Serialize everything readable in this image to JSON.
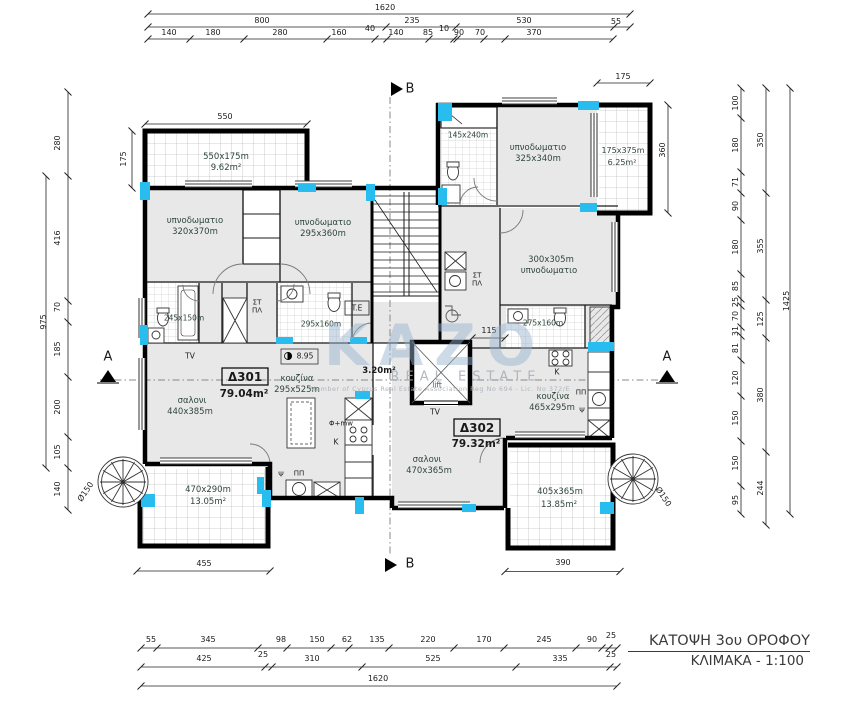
{
  "title_block": {
    "line1": "ΚΑΤΟΨΗ 3ου ΟΡΟΦΟΥ",
    "line2": "ΚΛΙΜΑΚΑ - 1:100"
  },
  "watermark": {
    "name": "KAZO",
    "subtitle": "REAL ESTATE",
    "note": "Member of Cyprus Real Estate Association   Reg No 694 - Lic. No 372/E"
  },
  "apartments": [
    {
      "id": "Δ301",
      "area": "79.04m²"
    },
    {
      "id": "Δ302",
      "area": "79.32m²"
    }
  ],
  "lift_area": "3.20m²",
  "level_mark": "8.95",
  "colors": {
    "marker": "#29BCEE",
    "room_fill": "#e8e8e8",
    "room_label": "#2e463b",
    "dim": "#1a1a1a"
  },
  "plan": {
    "labels": [
      {
        "t": "1620",
        "x": 385,
        "y": 8,
        "n": "dim-top"
      },
      {
        "t": "800",
        "x": 262,
        "y": 21,
        "n": "dim-top"
      },
      {
        "t": "235",
        "x": 412,
        "y": 21,
        "n": "dim-top"
      },
      {
        "t": "530",
        "x": 524,
        "y": 21,
        "n": "dim-top"
      },
      {
        "t": "55",
        "x": 616,
        "y": 22,
        "n": "dim-top"
      },
      {
        "t": "140",
        "x": 169,
        "y": 33,
        "n": "dim-top"
      },
      {
        "t": "180",
        "x": 213,
        "y": 33,
        "n": "dim-top"
      },
      {
        "t": "280",
        "x": 280,
        "y": 33,
        "n": "dim-top"
      },
      {
        "t": "160",
        "x": 339,
        "y": 33,
        "n": "dim-top"
      },
      {
        "t": "40",
        "x": 370,
        "y": 29,
        "n": "dim-top"
      },
      {
        "t": "140",
        "x": 396,
        "y": 33,
        "n": "dim-top"
      },
      {
        "t": "85",
        "x": 428,
        "y": 33,
        "n": "dim-top"
      },
      {
        "t": "10",
        "x": 444,
        "y": 29,
        "n": "dim-top"
      },
      {
        "t": "90",
        "x": 459,
        "y": 33,
        "n": "dim-top"
      },
      {
        "t": "70",
        "x": 480,
        "y": 33,
        "n": "dim-top"
      },
      {
        "t": "370",
        "x": 534,
        "y": 33,
        "n": "dim-top"
      },
      {
        "t": "550",
        "x": 225,
        "y": 117,
        "n": "dim-balcony"
      },
      {
        "t": "175",
        "x": 124,
        "y": 159,
        "r": -90,
        "n": "dim-balcony"
      },
      {
        "t": "175",
        "x": 623,
        "y": 77,
        "n": "dim-balcony"
      },
      {
        "t": "360",
        "x": 663,
        "y": 150,
        "r": -90,
        "n": "dim-balcony"
      },
      {
        "t": "115",
        "x": 489,
        "y": 331,
        "n": "dim-inner"
      },
      {
        "t": "455",
        "x": 204,
        "y": 564,
        "n": "dim-balcony"
      },
      {
        "t": "390",
        "x": 563,
        "y": 563,
        "n": "dim-balcony"
      },
      {
        "t": "55",
        "x": 151,
        "y": 640,
        "n": "dim-bottom"
      },
      {
        "t": "345",
        "x": 208,
        "y": 640,
        "n": "dim-bottom"
      },
      {
        "t": "98",
        "x": 281,
        "y": 640,
        "n": "dim-bottom"
      },
      {
        "t": "150",
        "x": 317,
        "y": 640,
        "n": "dim-bottom"
      },
      {
        "t": "62",
        "x": 347,
        "y": 640,
        "n": "dim-bottom"
      },
      {
        "t": "135",
        "x": 377,
        "y": 640,
        "n": "dim-bottom"
      },
      {
        "t": "220",
        "x": 428,
        "y": 640,
        "n": "dim-bottom"
      },
      {
        "t": "170",
        "x": 484,
        "y": 640,
        "n": "dim-bottom"
      },
      {
        "t": "245",
        "x": 544,
        "y": 640,
        "n": "dim-bottom"
      },
      {
        "t": "90",
        "x": 592,
        "y": 640,
        "n": "dim-bottom"
      },
      {
        "t": "25",
        "x": 611,
        "y": 636,
        "n": "dim-bottom"
      },
      {
        "t": "425",
        "x": 204,
        "y": 659,
        "n": "dim-bottom"
      },
      {
        "t": "25",
        "x": 263,
        "y": 655,
        "n": "dim-bottom"
      },
      {
        "t": "310",
        "x": 312,
        "y": 659,
        "n": "dim-bottom"
      },
      {
        "t": "525",
        "x": 433,
        "y": 659,
        "n": "dim-bottom"
      },
      {
        "t": "335",
        "x": 560,
        "y": 659,
        "n": "dim-bottom"
      },
      {
        "t": "25",
        "x": 611,
        "y": 655,
        "n": "dim-bottom"
      },
      {
        "t": "1620",
        "x": 378,
        "y": 679,
        "n": "dim-bottom"
      },
      {
        "t": "280",
        "x": 58,
        "y": 143,
        "r": -90,
        "n": "dim-left"
      },
      {
        "t": "416",
        "x": 58,
        "y": 238,
        "r": -90,
        "n": "dim-left"
      },
      {
        "t": "70",
        "x": 58,
        "y": 307,
        "r": -90,
        "n": "dim-left"
      },
      {
        "t": "185",
        "x": 58,
        "y": 349,
        "r": -90,
        "n": "dim-left"
      },
      {
        "t": "200",
        "x": 58,
        "y": 407,
        "r": -90,
        "n": "dim-left"
      },
      {
        "t": "105",
        "x": 58,
        "y": 452,
        "r": -90,
        "n": "dim-left"
      },
      {
        "t": "140",
        "x": 58,
        "y": 489,
        "r": -90,
        "n": "dim-left"
      },
      {
        "t": "975",
        "x": 44,
        "y": 322,
        "r": -90,
        "n": "dim-left"
      },
      {
        "t": "Ø150",
        "x": 86,
        "y": 492,
        "r": -56,
        "n": "dim-stair"
      },
      {
        "t": "Ø150",
        "x": 663,
        "y": 497,
        "r": 56,
        "n": "dim-stair"
      },
      {
        "t": "100",
        "x": 736,
        "y": 103,
        "r": -90,
        "n": "dim-right"
      },
      {
        "t": "180",
        "x": 736,
        "y": 145,
        "r": -90,
        "n": "dim-right"
      },
      {
        "t": "71",
        "x": 736,
        "y": 182,
        "r": -90,
        "n": "dim-right"
      },
      {
        "t": "90",
        "x": 736,
        "y": 206,
        "r": -90,
        "n": "dim-right"
      },
      {
        "t": "180",
        "x": 736,
        "y": 247,
        "r": -90,
        "n": "dim-right"
      },
      {
        "t": "85",
        "x": 736,
        "y": 286,
        "r": -90,
        "n": "dim-right"
      },
      {
        "t": "25",
        "x": 736,
        "y": 302,
        "r": -90,
        "n": "dim-right"
      },
      {
        "t": "70",
        "x": 736,
        "y": 316,
        "r": -90,
        "n": "dim-right"
      },
      {
        "t": "31",
        "x": 736,
        "y": 331,
        "r": -90,
        "n": "dim-right"
      },
      {
        "t": "81",
        "x": 736,
        "y": 348,
        "r": -90,
        "n": "dim-right"
      },
      {
        "t": "120",
        "x": 736,
        "y": 378,
        "r": -90,
        "n": "dim-right"
      },
      {
        "t": "150",
        "x": 736,
        "y": 418,
        "r": -90,
        "n": "dim-right"
      },
      {
        "t": "150",
        "x": 736,
        "y": 463,
        "r": -90,
        "n": "dim-right"
      },
      {
        "t": "95",
        "x": 736,
        "y": 500,
        "r": -90,
        "n": "dim-right"
      },
      {
        "t": "350",
        "x": 761,
        "y": 140,
        "r": -90,
        "n": "dim-right"
      },
      {
        "t": "355",
        "x": 761,
        "y": 246,
        "r": -90,
        "n": "dim-right"
      },
      {
        "t": "125",
        "x": 761,
        "y": 319,
        "r": -90,
        "n": "dim-right"
      },
      {
        "t": "380",
        "x": 761,
        "y": 395,
        "r": -90,
        "n": "dim-right"
      },
      {
        "t": "244",
        "x": 761,
        "y": 488,
        "r": -90,
        "n": "dim-right"
      },
      {
        "t": "1425",
        "x": 787,
        "y": 301,
        "r": -90,
        "n": "dim-right"
      },
      {
        "t": "550x175m",
        "x": 226,
        "y": 157,
        "s": 8.5,
        "c": "g",
        "n": "room-size"
      },
      {
        "t": "9.62m²",
        "x": 226,
        "y": 168,
        "s": 8.5,
        "c": "g",
        "n": "room-area"
      },
      {
        "t": "υπνοδωματιο",
        "x": 195,
        "y": 221,
        "s": 8.5,
        "c": "g",
        "n": "room-name"
      },
      {
        "t": "320x370m",
        "x": 195,
        "y": 232,
        "s": 8.5,
        "c": "g",
        "n": "room-size"
      },
      {
        "t": "υπνοδωματιο",
        "x": 323,
        "y": 223,
        "s": 8.5,
        "c": "g",
        "n": "room-name"
      },
      {
        "t": "295x360m",
        "x": 323,
        "y": 234,
        "s": 8.5,
        "c": "g",
        "n": "room-size"
      },
      {
        "t": "145x240m",
        "x": 468,
        "y": 135,
        "s": 7.5,
        "c": "g",
        "n": "room-size"
      },
      {
        "t": "υπνοδωματιο",
        "x": 538,
        "y": 148,
        "s": 8.5,
        "c": "g",
        "n": "room-name"
      },
      {
        "t": "325x340m",
        "x": 538,
        "y": 159,
        "s": 8.5,
        "c": "g",
        "n": "room-size"
      },
      {
        "t": "175x375m",
        "x": 623,
        "y": 151,
        "s": 8,
        "c": "g",
        "n": "room-size"
      },
      {
        "t": "6.25m²",
        "x": 622,
        "y": 163,
        "s": 8,
        "c": "g",
        "n": "room-area"
      },
      {
        "t": "300x305m",
        "x": 551,
        "y": 260,
        "s": 8.5,
        "c": "g",
        "n": "room-size"
      },
      {
        "t": "υπνοδωματιο",
        "x": 549,
        "y": 271,
        "s": 8.5,
        "c": "g",
        "n": "room-name"
      },
      {
        "t": "245x150m",
        "x": 184,
        "y": 318,
        "s": 7.5,
        "c": "g",
        "n": "room-size"
      },
      {
        "t": "295x160m",
        "x": 321,
        "y": 324,
        "s": 7.5,
        "c": "g",
        "n": "room-size"
      },
      {
        "t": "275x160m",
        "x": 543,
        "y": 323,
        "s": 7.5,
        "c": "g",
        "n": "room-size"
      },
      {
        "t": "κουζίνα",
        "x": 297,
        "y": 379,
        "s": 8.5,
        "c": "g",
        "n": "room-name"
      },
      {
        "t": "295x525m",
        "x": 297,
        "y": 390,
        "s": 8.5,
        "c": "g",
        "n": "room-size"
      },
      {
        "t": "σαλονι",
        "x": 192,
        "y": 401,
        "s": 8.5,
        "c": "g",
        "n": "room-name"
      },
      {
        "t": "440x385m",
        "x": 190,
        "y": 412,
        "s": 8.5,
        "c": "g",
        "n": "room-size"
      },
      {
        "t": "κουζίνα",
        "x": 553,
        "y": 397,
        "s": 8.5,
        "c": "g",
        "n": "room-name"
      },
      {
        "t": "465x295m",
        "x": 552,
        "y": 408,
        "s": 8.5,
        "c": "g",
        "n": "room-size"
      },
      {
        "t": "σαλονι",
        "x": 427,
        "y": 460,
        "s": 8.5,
        "c": "g",
        "n": "room-name"
      },
      {
        "t": "470x365m",
        "x": 429,
        "y": 471,
        "s": 8.5,
        "c": "g",
        "n": "room-size"
      },
      {
        "t": "470x290m",
        "x": 208,
        "y": 490,
        "s": 8.5,
        "c": "g",
        "n": "room-size"
      },
      {
        "t": "13.05m²",
        "x": 208,
        "y": 502,
        "s": 8.5,
        "c": "g",
        "n": "room-area"
      },
      {
        "t": "405x365m",
        "x": 560,
        "y": 492,
        "s": 8.5,
        "c": "g",
        "n": "room-size"
      },
      {
        "t": "13.85m²",
        "x": 559,
        "y": 505,
        "s": 8.5,
        "c": "g",
        "n": "room-area"
      },
      {
        "t": "ΣΤ",
        "x": 257,
        "y": 303,
        "s": 7,
        "n": "fixture-label"
      },
      {
        "t": "ΠΛ",
        "x": 257,
        "y": 311,
        "s": 7,
        "n": "fixture-label"
      },
      {
        "t": "ΣΤ",
        "x": 477,
        "y": 276,
        "s": 7,
        "n": "fixture-label"
      },
      {
        "t": "ΠΛ",
        "x": 477,
        "y": 284,
        "s": 7,
        "n": "fixture-label"
      },
      {
        "t": "T.E",
        "x": 357,
        "y": 308,
        "s": 7.5,
        "n": "fixture-label"
      },
      {
        "t": "TV",
        "x": 190,
        "y": 356,
        "s": 7.5,
        "n": "fixture-label"
      },
      {
        "t": "TV",
        "x": 435,
        "y": 412,
        "s": 7.5,
        "n": "fixture-label"
      },
      {
        "t": "K",
        "x": 557,
        "y": 372,
        "s": 7.5,
        "n": "fixture-label"
      },
      {
        "t": "K",
        "x": 336,
        "y": 442,
        "s": 7.5,
        "n": "fixture-label"
      },
      {
        "t": "ΠΠ",
        "x": 581,
        "y": 393,
        "s": 7,
        "n": "fixture-label"
      },
      {
        "t": "Ψ",
        "x": 582,
        "y": 411,
        "s": 7,
        "n": "fixture-label"
      },
      {
        "t": "Φ+mw",
        "x": 341,
        "y": 424,
        "s": 7,
        "n": "fixture-label"
      },
      {
        "t": "Ψ",
        "x": 281,
        "y": 475,
        "s": 7,
        "n": "fixture-label"
      },
      {
        "t": "ΠΠ",
        "x": 299,
        "y": 474,
        "s": 7,
        "n": "fixture-label"
      },
      {
        "t": "lift",
        "x": 437,
        "y": 385,
        "s": 7.5,
        "c": "#555555",
        "n": "lift-label"
      },
      {
        "t": "8.95",
        "x": 305,
        "y": 356,
        "s": 7.5,
        "n": "level-mark"
      },
      {
        "t": "3.20m²",
        "x": 379,
        "y": 371,
        "s": 8.5,
        "b": 1,
        "n": "lift-area"
      },
      {
        "t": "Δ301",
        "x": 245,
        "y": 377,
        "s": 12,
        "b": 1,
        "n": "apartment-id"
      },
      {
        "t": "79.04m²",
        "x": 244,
        "y": 394,
        "s": 10.5,
        "b": 1,
        "n": "apartment-area"
      },
      {
        "t": "Δ302",
        "x": 477,
        "y": 428,
        "s": 12,
        "b": 1,
        "n": "apartment-id"
      },
      {
        "t": "79.32m²",
        "x": 476,
        "y": 444,
        "s": 10.5,
        "b": 1,
        "n": "apartment-area"
      },
      {
        "t": "A",
        "x": 108,
        "y": 357,
        "s": 13,
        "n": "section-mark-a"
      },
      {
        "t": "A",
        "x": 667,
        "y": 357,
        "s": 13,
        "n": "section-mark-a"
      },
      {
        "t": "B",
        "x": 410,
        "y": 89,
        "s": 13,
        "n": "section-mark-b"
      },
      {
        "t": "B",
        "x": 410,
        "y": 564,
        "s": 13,
        "n": "section-mark-b"
      }
    ]
  }
}
